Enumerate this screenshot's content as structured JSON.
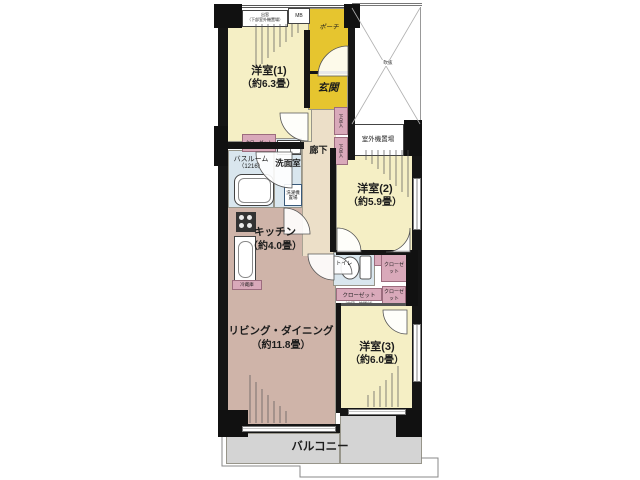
{
  "rooms": {
    "western1": {
      "name": "洋室(1)",
      "area": "（約6.3畳）"
    },
    "western2": {
      "name": "洋室(2)",
      "area": "（約5.9畳）"
    },
    "western3": {
      "name": "洋室(3)",
      "area": "（約6.0畳）"
    },
    "living_dining": {
      "name": "リビング・ダイニング",
      "area": "（約11.8畳）"
    },
    "kitchen": {
      "name": "キッチン",
      "area": "（約4.0畳）"
    },
    "bathroom": {
      "name": "バスルーム",
      "size": "（1216）"
    },
    "washroom": {
      "name": "洗面室"
    },
    "toilet": {
      "name": "トイレ"
    },
    "hallway": {
      "name": "廊下"
    },
    "entrance": {
      "name": "玄関"
    },
    "porch": {
      "name": "ポーチ"
    },
    "balcony": {
      "name": "バルコニー"
    }
  },
  "storage": {
    "closet_room1": {
      "name": "クローゼット"
    },
    "closet_room2": {
      "name": "クローゼット"
    },
    "closet_hall": {
      "name": "クローゼット",
      "note": "（中段・枕棚付）"
    },
    "closet_room3": {
      "name": "クローゼット"
    },
    "shoe_box_upper": {
      "name": "下足入"
    },
    "shoe_box_lower": {
      "name": "下足入"
    }
  },
  "facilities": {
    "meter_box": "MB",
    "bay_window_line1": "出窓",
    "bay_window_line2": "（下部室外機置場）",
    "outdoor_unit_space": "室外機置場",
    "washer_line1": "洗濯機",
    "washer_line2": "置場",
    "refrigerator": "冷蔵庫",
    "void_mark": "吹抜"
  },
  "colors": {
    "room_yellow": "#f5efc5",
    "entry_gold": "#e6c52f",
    "living_rose": "#cfb4a9",
    "water_blue": "#d9e6ee",
    "closet_pink": "#d9a9ba",
    "balcony_gray": "#d4d4d4",
    "hallway_beige": "#ecdfc8",
    "wall_black": "#151515"
  }
}
